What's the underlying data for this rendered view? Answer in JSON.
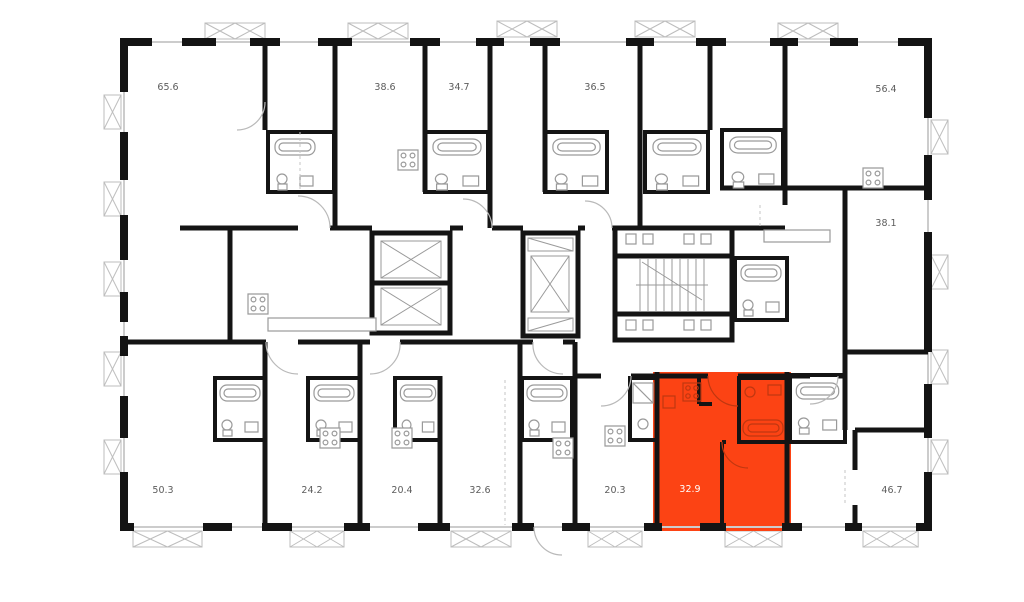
{
  "page": {
    "background": "#ffffff"
  },
  "colors": {
    "highlight_fill": "#fc4314",
    "wall": "#141414",
    "window_line": "#cccccc",
    "fixture_line": "#9a9a9a",
    "label_text": "#5c5c5c",
    "highlight_label_text": "#ffffff"
  },
  "floorplan": {
    "selected_unit": {
      "area": "32.9",
      "highlighted": true
    },
    "units": [
      {
        "area": "65.6"
      },
      {
        "area": "38.6"
      },
      {
        "area": "34.7"
      },
      {
        "area": "36.5"
      },
      {
        "area": "56.4"
      },
      {
        "area": "38.1"
      },
      {
        "area": "50.3"
      },
      {
        "area": "24.2"
      },
      {
        "area": "20.4"
      },
      {
        "area": "32.6"
      },
      {
        "area": "20.3"
      },
      {
        "area": "32.9"
      },
      {
        "area": "46.7"
      }
    ]
  }
}
